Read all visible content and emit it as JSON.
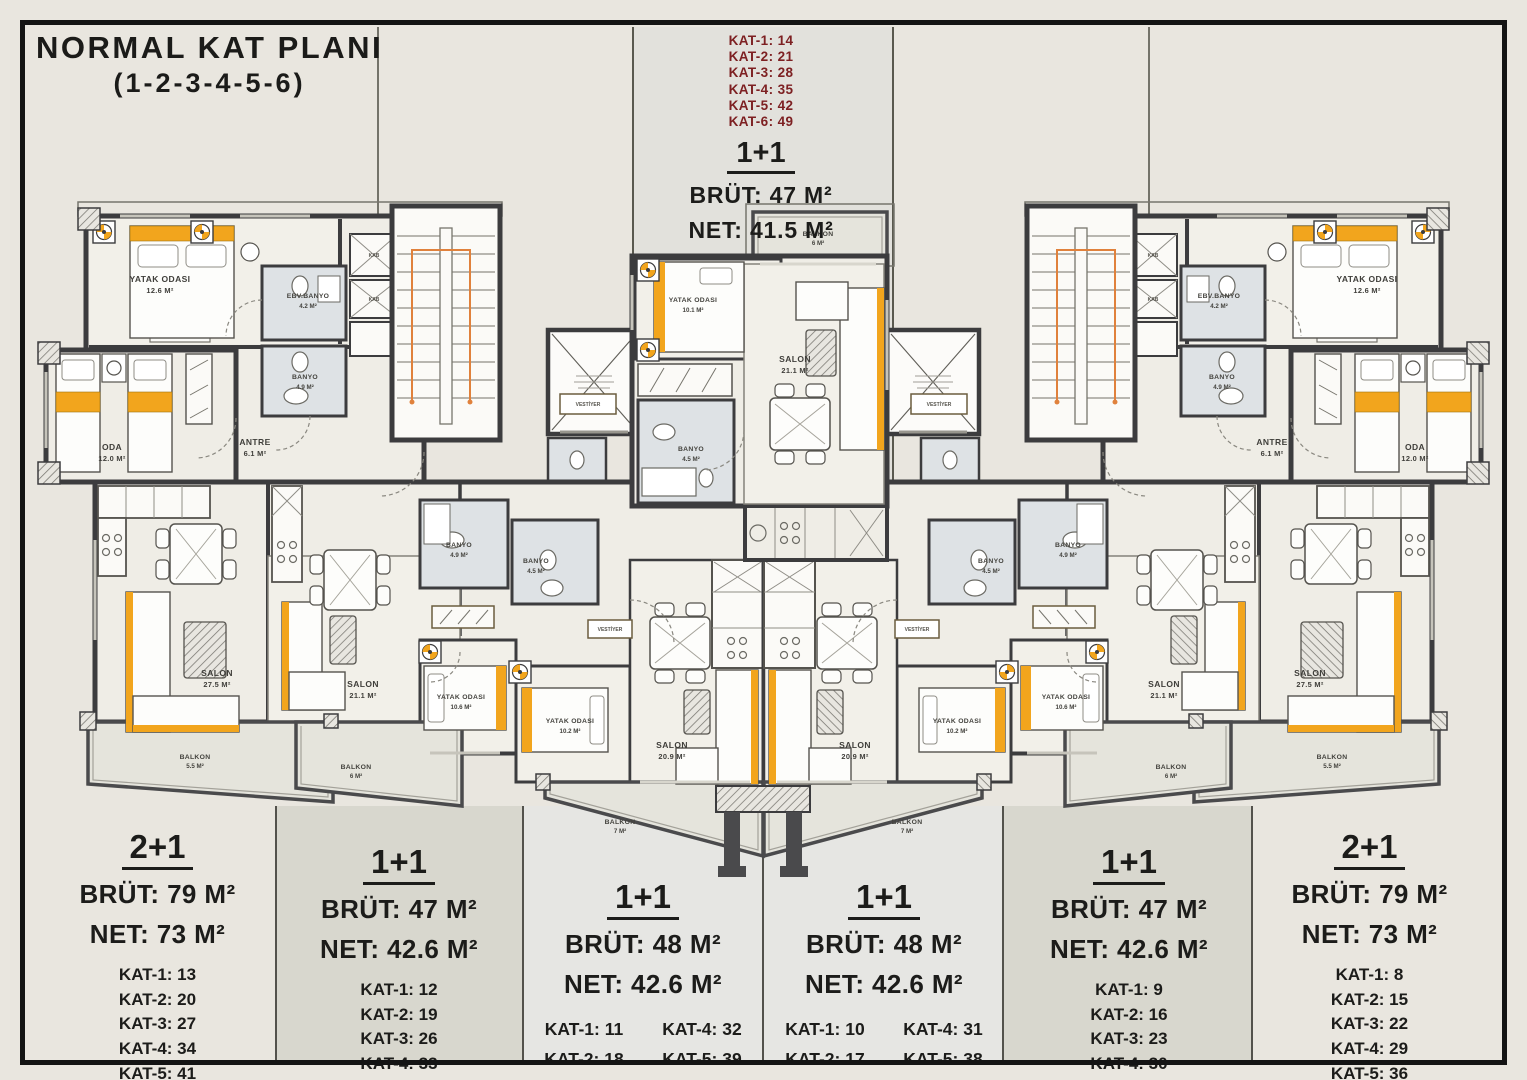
{
  "title": {
    "line1": "NORMAL KAT PLANI",
    "line2": "(1-2-3-4-5-6)"
  },
  "top_unit": {
    "floors": [
      "KAT-1: 14",
      "KAT-2: 21",
      "KAT-3: 28",
      "KAT-4: 35",
      "KAT-5: 42",
      "KAT-6: 49"
    ],
    "type": "1+1",
    "brut": "BRÜT: 47 M²",
    "net": "NET: 41.5 M²"
  },
  "units": [
    {
      "type": "2+1",
      "brut": "BRÜT: 79 M²",
      "net": "NET: 73 M²",
      "floors": [
        "KAT-1: 13",
        "KAT-2: 20",
        "KAT-3: 27",
        "KAT-4: 34",
        "KAT-5: 41",
        "KAT-6: 48"
      ]
    },
    {
      "type": "1+1",
      "brut": "BRÜT: 47 M²",
      "net": "NET: 42.6 M²",
      "floors": [
        "KAT-1: 12",
        "KAT-2: 19",
        "KAT-3: 26",
        "KAT-4: 33",
        "KAT-5: 40",
        "KAT-6: 47"
      ]
    },
    {
      "type": "1+1",
      "brut": "BRÜT: 48 M²",
      "net": "NET: 42.6 M²",
      "floors": [
        "KAT-1: 11",
        "KAT-2: 18",
        "KAT-3: 25",
        "KAT-4: 32",
        "KAT-5: 39",
        "KAT-6: 46"
      ]
    },
    {
      "type": "1+1",
      "brut": "BRÜT: 48 M²",
      "net": "NET: 42.6 M²",
      "floors": [
        "KAT-1: 10",
        "KAT-2: 17",
        "KAT-3: 24",
        "KAT-4: 31",
        "KAT-5: 38",
        "KAT-6: 45"
      ]
    },
    {
      "type": "1+1",
      "brut": "BRÜT: 47 M²",
      "net": "NET: 42.6 M²",
      "floors": [
        "KAT-1: 9",
        "KAT-2: 16",
        "KAT-3: 23",
        "KAT-4: 30",
        "KAT-5: 37",
        "KAT-6: 44"
      ]
    },
    {
      "type": "2+1",
      "brut": "BRÜT: 79 M²",
      "net": "NET: 73 M²",
      "floors": [
        "KAT-1: 8",
        "KAT-2: 15",
        "KAT-3: 22",
        "KAT-4: 29",
        "KAT-5: 36",
        "KAT-6: 43"
      ]
    }
  ],
  "rooms": {
    "yatak_126": {
      "name": "YATAK ODASI",
      "area": "12.6 M²"
    },
    "yatak_101": {
      "name": "YATAK ODASI",
      "area": "10.1 M²"
    },
    "yatak_106": {
      "name": "YATAK ODASI",
      "area": "10.6 M²"
    },
    "yatak_102": {
      "name": "YATAK ODASI",
      "area": "10.2 M²"
    },
    "oda": {
      "name": "ODA",
      "area": "12.0 M²"
    },
    "antre": {
      "name": "ANTRE",
      "area": "6.1 M²"
    },
    "ebv_banyo": {
      "name": "EBV.BANYO",
      "area": "4.2 M²"
    },
    "banyo_49": {
      "name": "BANYO",
      "area": "4.9 M²"
    },
    "banyo_45": {
      "name": "BANYO",
      "area": "4.5 M²"
    },
    "salon_275": {
      "name": "SALON",
      "area": "27.5 M²"
    },
    "salon_211": {
      "name": "SALON",
      "area": "21.1 M²"
    },
    "salon_209": {
      "name": "SALON",
      "area": "20.9 M²"
    },
    "balkon_55": {
      "name": "BALKON",
      "area": "5.5 M²"
    },
    "balkon_6": {
      "name": "BALKON",
      "area": "6 M²"
    },
    "balkon_7": {
      "name": "BALKON",
      "area": "7 M²"
    },
    "kab": {
      "name": "KAB"
    },
    "vestiyer": {
      "name": "VESTİYER"
    }
  },
  "colors": {
    "accent_yellow": "#f2a51d",
    "wall": "#3c3c3e",
    "kat_maroon": "#7d2022",
    "stair_guide": "#e0813c"
  }
}
